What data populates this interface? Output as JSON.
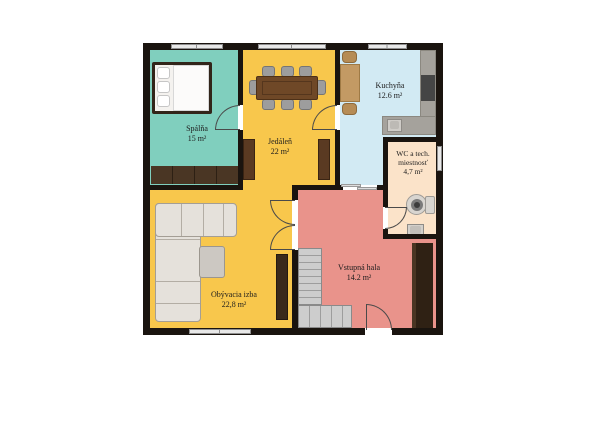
{
  "plan": {
    "type": "floor-plan",
    "rooms": [
      {
        "name": "Spálňa",
        "area": "15 m²",
        "color": "#80cfbe"
      },
      {
        "name": "Jedáleň",
        "area": "22 m²",
        "color": "#f8c74c"
      },
      {
        "name": "Kuchyňa",
        "area": "12.6 m²",
        "color": "#d2eaf3"
      },
      {
        "name_line1": "WC a tech.",
        "name_line2": "miestnosť",
        "area": "4,7 m²",
        "color": "#fbe3c9"
      },
      {
        "name": "Obývacia izba",
        "area": "22,8 m²",
        "color": "#f8c74c"
      },
      {
        "name": "Vstupná hala",
        "area": "14.2 m²",
        "color": "#e9938b"
      }
    ],
    "furniture": {
      "bedroom": [
        "bed",
        "wardrobe"
      ],
      "dining": [
        "dining-table",
        "eight-chairs",
        "cabinet",
        "cabinet"
      ],
      "kitchen": [
        "kitchen-table",
        "two-chairs",
        "counter",
        "sink",
        "stove"
      ],
      "wc": [
        "washing-machine",
        "sink"
      ],
      "living": [
        "corner-sofa",
        "coffee-table",
        "tv-cabinet"
      ],
      "hall": [
        "staircase",
        "wardrobe"
      ]
    },
    "colors": {
      "wall": "#1a140f",
      "background": "#ffffff",
      "stairs": "#cdcdcd"
    }
  }
}
